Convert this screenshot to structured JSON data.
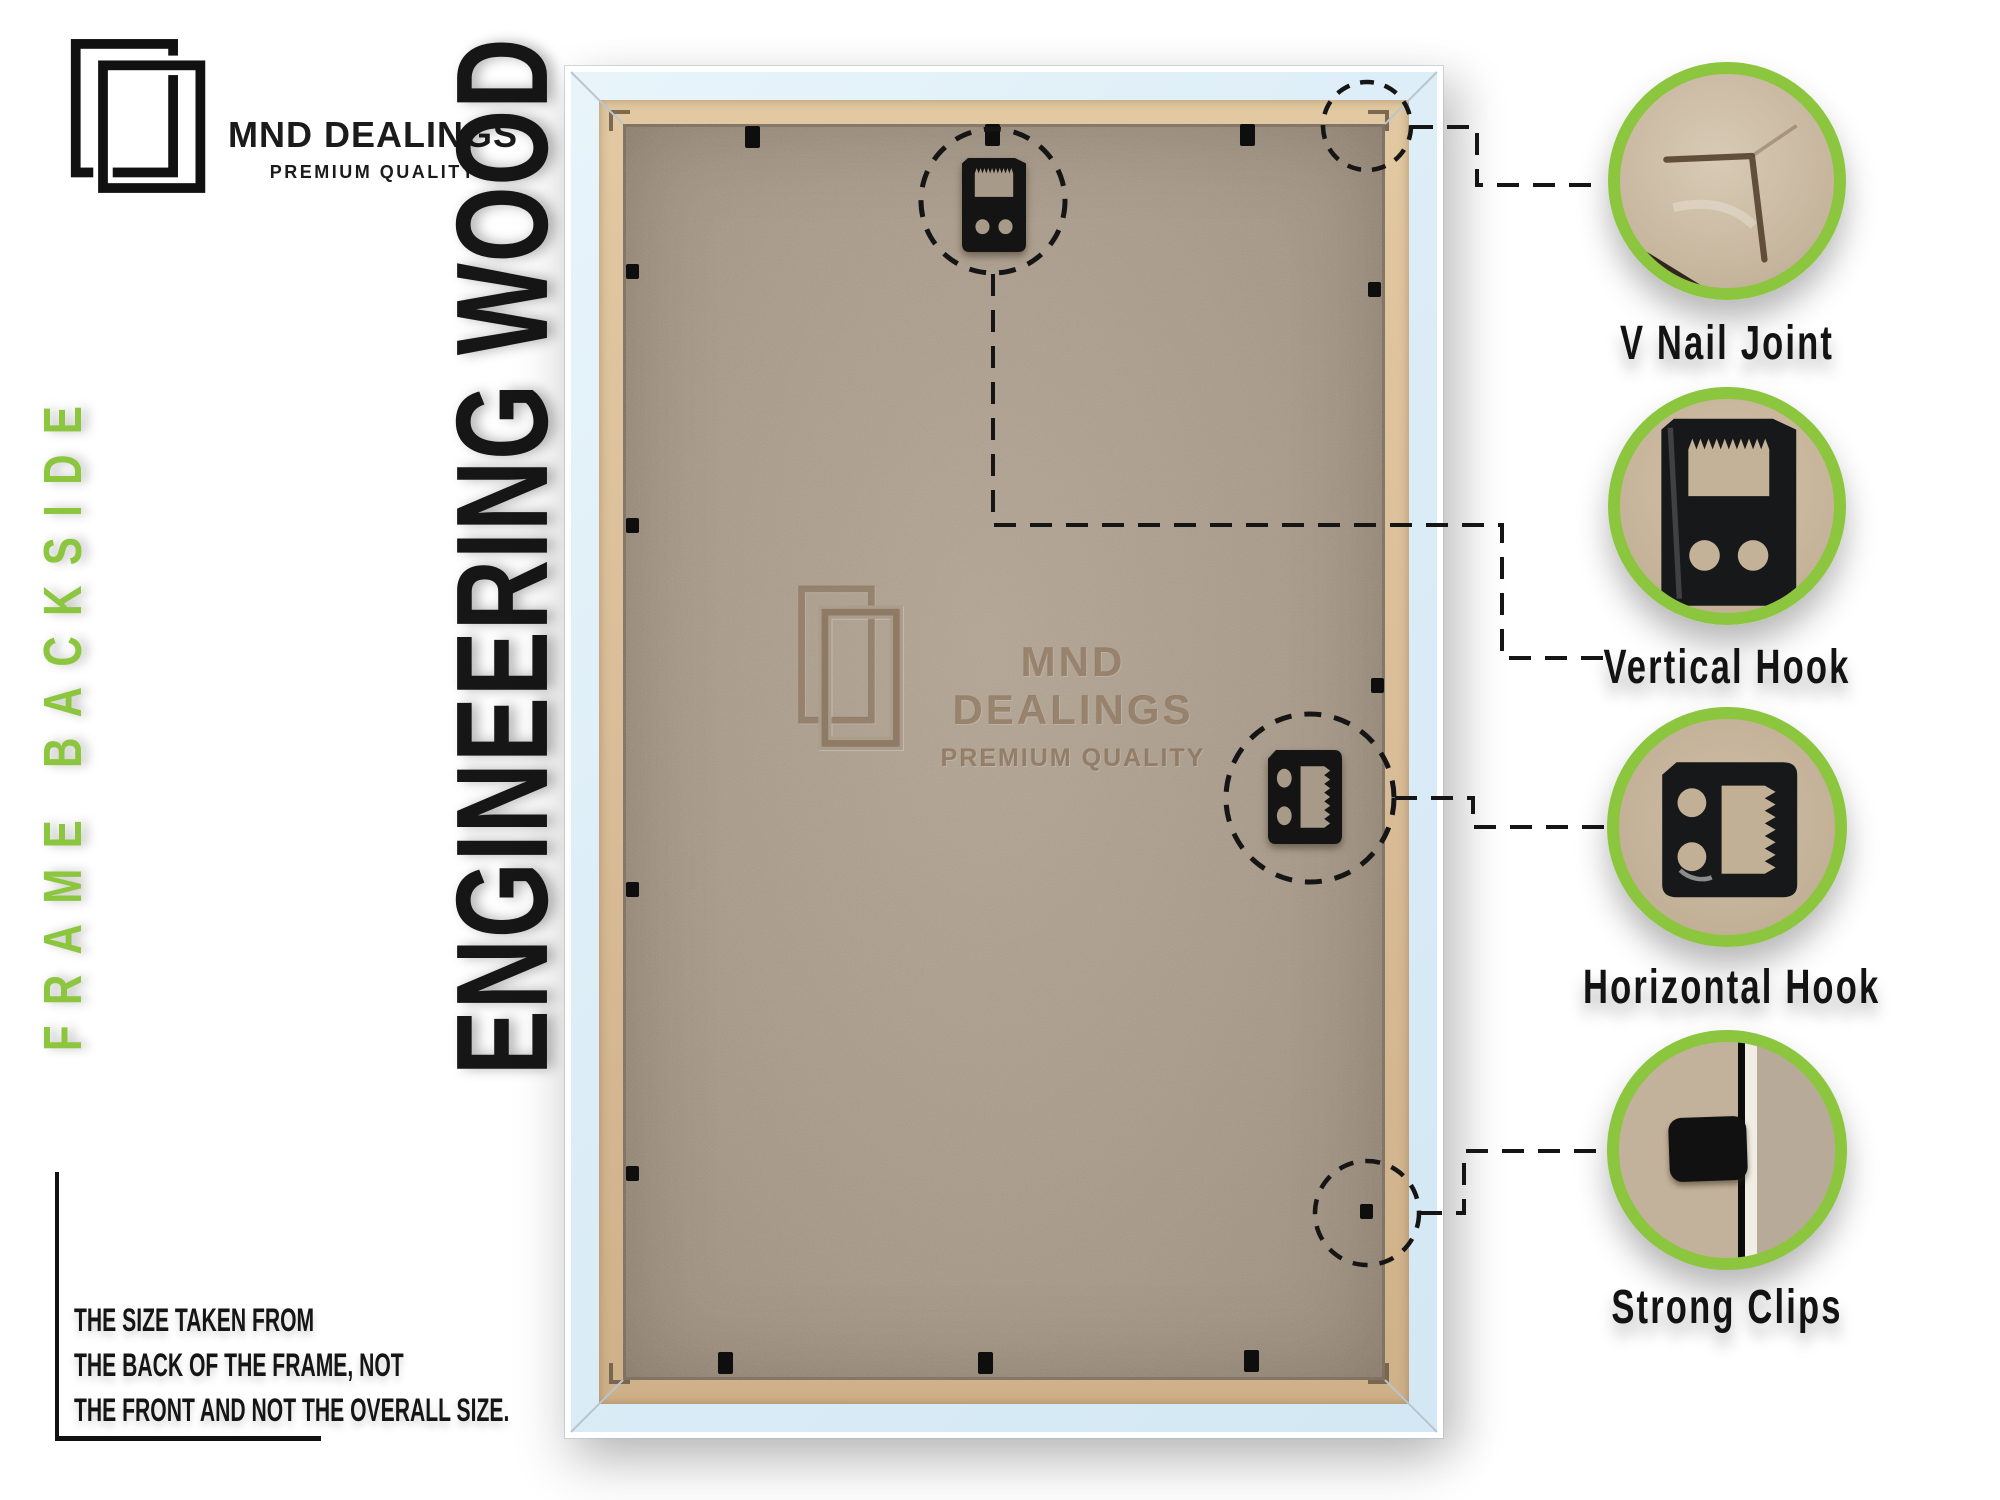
{
  "brand": {
    "name": "MND DEALINGS",
    "tagline": "PREMIUM QUALITY"
  },
  "side_label": "FRAME BACKSIDE",
  "material_label": "ENGINEERING WOOD",
  "size_note": {
    "line1": "THE SIZE TAKEN FROM",
    "line2": "THE BACK OF THE FRAME, NOT",
    "line3": "THE FRONT AND NOT THE OVERALL SIZE."
  },
  "watermark": {
    "name": "MND DEALINGS",
    "tagline": "PREMIUM QUALITY"
  },
  "callouts": [
    {
      "id": "v-nail-joint",
      "label": "V Nail Joint"
    },
    {
      "id": "vertical-hook",
      "label": "Vertical Hook"
    },
    {
      "id": "horizontal-hook",
      "label": "Horizontal Hook"
    },
    {
      "id": "strong-clips",
      "label": "Strong Clips"
    }
  ],
  "colors": {
    "accent_green": "#8CC63F",
    "ink": "#141414",
    "frame_white": "#FFFFFF",
    "frame_blue": "#DCEDF7",
    "frame_wood": "#D9BD98",
    "board": "#A89A89",
    "cardboard": "#C9B8A0"
  }
}
